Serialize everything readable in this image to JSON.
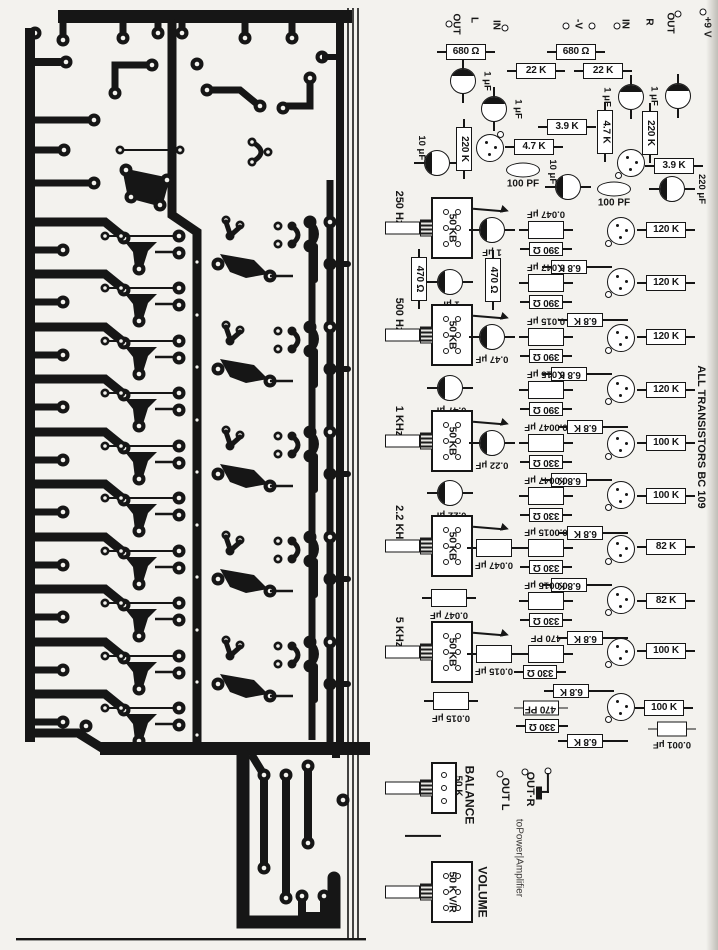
{
  "colors": {
    "ink": "#161616",
    "paper": "#f3f2ee"
  },
  "note": "ALL TRANSISTORS BC 109",
  "components": [
    {
      "t": "pad",
      "x": 449,
      "y": 24
    },
    {
      "t": "vt",
      "l": "OUT",
      "x": 455,
      "y": 24,
      "size": 10,
      "n": "label-out-l"
    },
    {
      "t": "vt",
      "l": "L",
      "x": 473,
      "y": 20,
      "size": 10
    },
    {
      "t": "vt",
      "l": "IN",
      "x": 495,
      "y": 25,
      "size": 10,
      "n": "label-in-l"
    },
    {
      "t": "pad",
      "x": 505,
      "y": 28
    },
    {
      "t": "pad",
      "x": 566,
      "y": 26
    },
    {
      "t": "vt",
      "l": "-V",
      "x": 577,
      "y": 24,
      "size": 10,
      "n": "label-neg-v"
    },
    {
      "t": "pad",
      "x": 592,
      "y": 26
    },
    {
      "t": "pad",
      "x": 617,
      "y": 26
    },
    {
      "t": "vt",
      "l": "IN",
      "x": 624,
      "y": 24,
      "size": 10,
      "n": "label-in-r"
    },
    {
      "t": "vt",
      "l": "R",
      "x": 648,
      "y": 22,
      "size": 10
    },
    {
      "t": "vt",
      "l": "OUT",
      "x": 669,
      "y": 23,
      "size": 10,
      "n": "label-out-r-top"
    },
    {
      "t": "pad",
      "x": 678,
      "y": 14
    },
    {
      "t": "pad",
      "x": 703,
      "y": 12
    },
    {
      "t": "vt",
      "l": "+9 V",
      "x": 706,
      "y": 27,
      "size": 10,
      "n": "label-plus-9v"
    },
    {
      "t": "rh",
      "l": "680 Ω",
      "x": 466,
      "y": 52
    },
    {
      "t": "cc",
      "l": "1 μF",
      "x": 463,
      "y": 81,
      "leads": "v",
      "cres": "t",
      "lp": "r"
    },
    {
      "t": "cc",
      "l": "1 μF",
      "x": 494,
      "y": 109,
      "leads": "v",
      "cres": "t",
      "lp": "r"
    },
    {
      "t": "rh",
      "l": "22 K",
      "x": 536,
      "y": 71
    },
    {
      "t": "rh",
      "l": "680 Ω",
      "x": 576,
      "y": 52
    },
    {
      "t": "rh",
      "l": "22 K",
      "x": 603,
      "y": 71
    },
    {
      "t": "cc",
      "l": "1 μF",
      "x": 631,
      "y": 97,
      "leads": "v",
      "cres": "t",
      "lp": "l"
    },
    {
      "t": "cc",
      "l": "1 μF",
      "x": 678,
      "y": 96,
      "leads": "v",
      "cres": "t",
      "lp": "l"
    },
    {
      "t": "cc",
      "l": "10 μF",
      "x": 437,
      "y": 163,
      "leads": "h",
      "cres": "l",
      "lp": "t"
    },
    {
      "t": "rv",
      "l": "220 K",
      "x": 464,
      "y": 149
    },
    {
      "t": "tr",
      "x": 490,
      "y": 148,
      "tab": "tr"
    },
    {
      "t": "rh",
      "l": "3.9 K",
      "x": 567,
      "y": 127
    },
    {
      "t": "rh",
      "l": "4.7 K",
      "x": 534,
      "y": 147
    },
    {
      "t": "rv",
      "l": "4.7 K",
      "x": 605,
      "y": 132
    },
    {
      "t": "rv",
      "l": "220 K",
      "x": 650,
      "y": 133
    },
    {
      "t": "lens",
      "l": "100 PF",
      "x": 523,
      "y": 170
    },
    {
      "t": "cc",
      "l": "10 μF",
      "x": 568,
      "y": 187,
      "leads": "h",
      "cres": "l",
      "lp": "t"
    },
    {
      "t": "tr",
      "x": 631,
      "y": 163,
      "tab": "bl"
    },
    {
      "t": "rh",
      "l": "3.9 K",
      "x": 674,
      "y": 166
    },
    {
      "t": "lens",
      "l": "100 PF",
      "x": 614,
      "y": 189
    },
    {
      "t": "cc",
      "l": "220 μF",
      "x": 672,
      "y": 189,
      "leads": "h",
      "cres": "l",
      "lp": "r"
    },
    {
      "t": "vt",
      "l": "250 Hz",
      "x": 398,
      "y": 208,
      "n": "label-250hz"
    },
    {
      "t": "pot",
      "x": 452,
      "y": 228,
      "l": "50 KB",
      "holes": 6,
      "n": "pot-250hz"
    },
    {
      "t": "arr",
      "x": 491,
      "y": 208
    },
    {
      "t": "cc",
      "l": "1 μF",
      "x": 492,
      "y": 230,
      "leads": "h",
      "cres": "l",
      "lp": "b"
    },
    {
      "t": "cr",
      "l": "0.047 μF",
      "x": 546,
      "y": 230,
      "lp": "t"
    },
    {
      "t": "rh180",
      "l": "390 Ω",
      "x": 546,
      "y": 249,
      "w": 34,
      "h": 14
    },
    {
      "t": "rh180",
      "l": "6.8 K",
      "x": 569,
      "y": 267,
      "w": 36,
      "h": 14,
      "lx": 26
    },
    {
      "t": "tr",
      "x": 621,
      "y": 231,
      "tab": "bl"
    },
    {
      "t": "rh",
      "l": "120 K",
      "x": 666,
      "y": 230
    },
    {
      "t": "rv",
      "l": "470 Ω",
      "x": 419,
      "y": 279
    },
    {
      "t": "cc",
      "l": "1 μF",
      "x": 450,
      "y": 282,
      "leads": "h",
      "cres": "l",
      "lp": "b"
    },
    {
      "t": "rv",
      "l": "470 Ω",
      "x": 493,
      "y": 280
    },
    {
      "t": "cr",
      "l": "0.047 μF",
      "x": 546,
      "y": 283,
      "lp": "t"
    },
    {
      "t": "rh180",
      "l": "390 Ω",
      "x": 546,
      "y": 302,
      "w": 34,
      "h": 14
    },
    {
      "t": "rh180",
      "l": "6.8 K",
      "x": 585,
      "y": 320,
      "w": 36,
      "h": 14,
      "lx": 26
    },
    {
      "t": "tr",
      "x": 621,
      "y": 282,
      "tab": "bl"
    },
    {
      "t": "rh",
      "l": "120 K",
      "x": 666,
      "y": 283
    },
    {
      "t": "vt",
      "l": "500 Hz",
      "x": 398,
      "y": 315,
      "n": "label-500hz"
    },
    {
      "t": "pot",
      "x": 452,
      "y": 335,
      "l": "50 KB",
      "holes": 6,
      "n": "pot-500hz"
    },
    {
      "t": "arr",
      "x": 491,
      "y": 315
    },
    {
      "t": "cc",
      "l": "0.47 μF",
      "x": 492,
      "y": 337,
      "leads": "h",
      "cres": "l",
      "lp": "b"
    },
    {
      "t": "cr",
      "l": "0.015 μF",
      "x": 546,
      "y": 337,
      "lp": "t"
    },
    {
      "t": "rh180",
      "l": "390 Ω",
      "x": 546,
      "y": 356,
      "w": 34,
      "h": 14
    },
    {
      "t": "rh180",
      "l": "6.8 K",
      "x": 569,
      "y": 374,
      "w": 36,
      "h": 14,
      "lx": 26
    },
    {
      "t": "tr",
      "x": 621,
      "y": 338,
      "tab": "bl"
    },
    {
      "t": "rh",
      "l": "120 K",
      "x": 666,
      "y": 337
    },
    {
      "t": "cc",
      "l": "0.47 μF",
      "x": 450,
      "y": 388,
      "leads": "h",
      "cres": "l",
      "lp": "b"
    },
    {
      "t": "cr",
      "l": "0.015 μF",
      "x": 546,
      "y": 390,
      "lp": "t"
    },
    {
      "t": "rh180",
      "l": "390 Ω",
      "x": 546,
      "y": 409,
      "w": 34,
      "h": 14
    },
    {
      "t": "rh180",
      "l": "6.8 K",
      "x": 585,
      "y": 427,
      "w": 36,
      "h": 14,
      "lx": 26
    },
    {
      "t": "tr",
      "x": 621,
      "y": 389,
      "tab": "bl"
    },
    {
      "t": "rh",
      "l": "120 K",
      "x": 666,
      "y": 390
    },
    {
      "t": "vt",
      "l": "1 KHz",
      "x": 398,
      "y": 421,
      "n": "label-1khz"
    },
    {
      "t": "pot",
      "x": 452,
      "y": 441,
      "l": "50 KB",
      "holes": 6,
      "n": "pot-1khz"
    },
    {
      "t": "arr",
      "x": 491,
      "y": 421
    },
    {
      "t": "cc",
      "l": "0.22 μF",
      "x": 492,
      "y": 443,
      "leads": "h",
      "cres": "l",
      "lp": "b"
    },
    {
      "t": "cr",
      "l": "0.0047 μF",
      "x": 546,
      "y": 443,
      "lp": "t"
    },
    {
      "t": "rh180",
      "l": "330 Ω",
      "x": 546,
      "y": 462,
      "w": 34,
      "h": 14
    },
    {
      "t": "rh180",
      "l": "6.8 K",
      "x": 569,
      "y": 480,
      "w": 36,
      "h": 14,
      "lx": 26
    },
    {
      "t": "tr",
      "x": 621,
      "y": 444,
      "tab": "bl"
    },
    {
      "t": "rh",
      "l": "100 K",
      "x": 666,
      "y": 443
    },
    {
      "t": "cc",
      "l": "0.22 μF",
      "x": 450,
      "y": 493,
      "leads": "h",
      "cres": "l",
      "lp": "b"
    },
    {
      "t": "cr",
      "l": "0.0047 μF",
      "x": 546,
      "y": 496,
      "lp": "t"
    },
    {
      "t": "rh180",
      "l": "330 Ω",
      "x": 546,
      "y": 515,
      "w": 34,
      "h": 14
    },
    {
      "t": "rh180",
      "l": "6.8 K",
      "x": 585,
      "y": 533,
      "w": 36,
      "h": 14,
      "lx": 26
    },
    {
      "t": "tr",
      "x": 621,
      "y": 495,
      "tab": "bl"
    },
    {
      "t": "rh",
      "l": "100 K",
      "x": 666,
      "y": 496
    },
    {
      "t": "vt",
      "l": "2.2 KHz",
      "x": 398,
      "y": 525,
      "n": "label-2-2khz"
    },
    {
      "t": "pot",
      "x": 452,
      "y": 546,
      "l": "50 KB",
      "holes": 6,
      "n": "pot-2-2khz"
    },
    {
      "t": "arr",
      "x": 491,
      "y": 526
    },
    {
      "t": "cr",
      "l": "0.047 μF",
      "x": 494,
      "y": 548,
      "lp": "b"
    },
    {
      "t": "cr",
      "l": "0.0015 μF",
      "x": 546,
      "y": 548,
      "lp": "t"
    },
    {
      "t": "rh180",
      "l": "330 Ω",
      "x": 546,
      "y": 567,
      "w": 34,
      "h": 14
    },
    {
      "t": "rh180",
      "l": "6.8 K",
      "x": 569,
      "y": 585,
      "w": 36,
      "h": 14,
      "lx": 26
    },
    {
      "t": "tr",
      "x": 621,
      "y": 549,
      "tab": "bl"
    },
    {
      "t": "rh",
      "l": "82 K",
      "x": 666,
      "y": 547
    },
    {
      "t": "cr",
      "l": "0.047 μF",
      "x": 449,
      "y": 598,
      "lp": "b"
    },
    {
      "t": "cr",
      "l": "0.0015 μF",
      "x": 546,
      "y": 601,
      "lp": "t"
    },
    {
      "t": "rh180",
      "l": "330 Ω",
      "x": 546,
      "y": 620,
      "w": 34,
      "h": 14
    },
    {
      "t": "rh180",
      "l": "6.8 K",
      "x": 585,
      "y": 638,
      "w": 36,
      "h": 14,
      "lx": 26
    },
    {
      "t": "tr",
      "x": 621,
      "y": 600,
      "tab": "bl"
    },
    {
      "t": "rh",
      "l": "82 K",
      "x": 666,
      "y": 601
    },
    {
      "t": "vt",
      "l": "5 KHz",
      "x": 398,
      "y": 632,
      "n": "label-5khz"
    },
    {
      "t": "pot",
      "x": 452,
      "y": 652,
      "l": "50 KB",
      "holes": 6,
      "n": "pot-5khz"
    },
    {
      "t": "arr",
      "x": 491,
      "y": 632
    },
    {
      "t": "cr",
      "l": "0.015 μF",
      "x": 494,
      "y": 654,
      "lp": "b"
    },
    {
      "t": "cr",
      "l": "470 PF",
      "x": 546,
      "y": 654,
      "lp": "t"
    },
    {
      "t": "rh180",
      "l": "330 Ω",
      "x": 540,
      "y": 672,
      "w": 34,
      "h": 14
    },
    {
      "t": "rh180",
      "l": "6.8 K",
      "x": 571,
      "y": 691,
      "w": 36,
      "h": 14,
      "lx": 26
    },
    {
      "t": "tr",
      "x": 621,
      "y": 652,
      "tab": "bl"
    },
    {
      "t": "rh",
      "l": "100 K",
      "x": 666,
      "y": 651
    },
    {
      "t": "cr",
      "l": "0.015 μF",
      "x": 451,
      "y": 701,
      "lp": "b"
    },
    {
      "t": "rh180",
      "l": "470 PF",
      "x": 541,
      "y": 708,
      "w": 36,
      "h": 15
    },
    {
      "t": "rh180",
      "l": "330 Ω",
      "x": 542,
      "y": 726,
      "w": 34,
      "h": 14
    },
    {
      "t": "rh180",
      "l": "6.8 K",
      "x": 585,
      "y": 741,
      "w": 36,
      "h": 14,
      "lx": 26
    },
    {
      "t": "tr",
      "x": 621,
      "y": 707,
      "tab": "bl"
    },
    {
      "t": "rh",
      "l": "100 K",
      "x": 664,
      "y": 708
    },
    {
      "t": "cr",
      "l": "0.001 μF",
      "x": 672,
      "y": 729,
      "lp": "b",
      "w": 30,
      "h": 15
    },
    {
      "t": "vt",
      "l": "ALL TRANSISTORS BC 109",
      "x": 700,
      "y": 437,
      "size": 11,
      "n": "label-all-transistors-bc109"
    },
    {
      "t": "wh",
      "x": 423,
      "y": 836,
      "w": 36
    },
    {
      "t": "pot",
      "x": 444,
      "y": 788,
      "w": 26,
      "h": 52,
      "holes": 3,
      "n": "pot-balance"
    },
    {
      "t": "vt",
      "l": "50 K",
      "x": 457,
      "y": 786,
      "size": 10,
      "n": "label-balance-50k"
    },
    {
      "t": "vt",
      "l": "BALANCE",
      "x": 469,
      "y": 795,
      "size": 12,
      "n": "label-balance"
    },
    {
      "t": "pad",
      "x": 500,
      "y": 774
    },
    {
      "t": "vt",
      "l": "OUT L",
      "x": 504,
      "y": 794,
      "size": 11,
      "n": "label-out-l-bottom"
    },
    {
      "t": "pad",
      "x": 525,
      "y": 772
    },
    {
      "t": "vt",
      "l": "OUT·R",
      "x": 529,
      "y": 789,
      "size": 11,
      "n": "label-out-r-bottom"
    },
    {
      "t": "pad",
      "x": 548,
      "y": 771
    },
    {
      "t": "wv",
      "x": 548,
      "y": 783,
      "h": 20
    },
    {
      "t": "wh",
      "x": 545,
      "y": 792,
      "w": 8
    },
    {
      "t": "blob",
      "x": 539,
      "y": 793,
      "w": 6,
      "h": 13,
      "n": "jumper-blob"
    },
    {
      "t": "vt",
      "l": "toPower|Amplifier",
      "x": 518,
      "y": 858,
      "size": 10,
      "light": true,
      "n": "label-to-power-amplifier"
    },
    {
      "t": "pot",
      "x": 452,
      "y": 892,
      "l": "50 K V/R",
      "holes": 6,
      "n": "pot-volume"
    },
    {
      "t": "vt",
      "l": "VOLUME",
      "x": 482,
      "y": 892,
      "size": 12,
      "n": "label-volume"
    }
  ]
}
